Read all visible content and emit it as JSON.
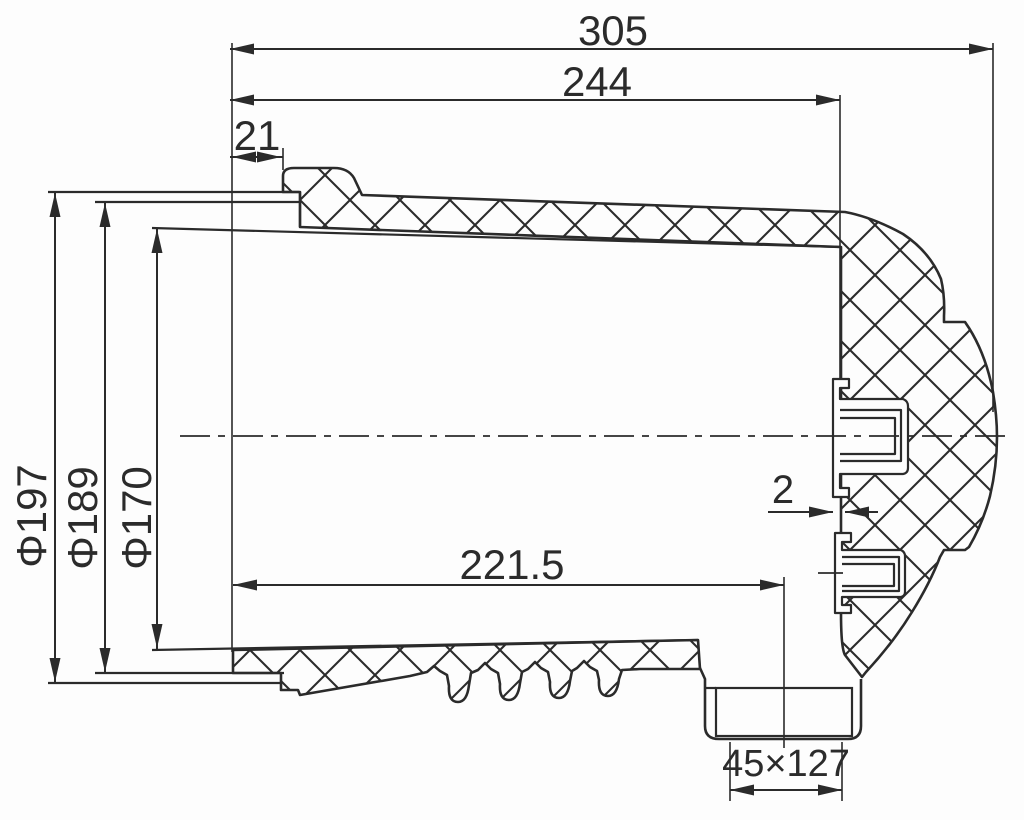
{
  "meta": {
    "kind": "engineering-cross-section-drawing",
    "background": "#fdfdfd",
    "line_color": "#2b2b2b",
    "hatch_spacing": 50
  },
  "dimensions": {
    "overall_length": {
      "label": "305"
    },
    "flange_to_insert": {
      "label": "244"
    },
    "collar_offset": {
      "label": "21"
    },
    "outer_diameter": {
      "label": "Φ197"
    },
    "flange_diameter": {
      "label": "Φ189"
    },
    "opening_diameter": {
      "label": "Φ170"
    },
    "depth_to_hole": {
      "label": "221.5"
    },
    "insert_gap": {
      "label": "2"
    },
    "duct_hole": {
      "label": "45×127"
    }
  },
  "svg_elements": [
    {
      "kind": "path",
      "name": "upper-wall-and-dome-section",
      "d": "M 300,227 L 300,192 L 283,192 L 283,176 Q 283,168 294,168 L 334,168 Q 348,168 354,178 L 362,195 L 845,212 Q 872,217 903,234 Q 930,252 941,279 Q 945,296 944,316 L 944,322 L 965,322 L 969,328 Q 986,355 993,392 Q 997,416 997,437 Q 997,466 990,496 Q 983,523 969,547 L 965,550 L 944,550 L 940,557 Q 930,583 912,612 Q 893,643 866,672 L 862,677 L 845,655 Q 841,648 841,613 L 841,247 Z",
      "fill": "hatch",
      "w": 2.6
    },
    {
      "kind": "path",
      "name": "lower-wall-section",
      "d": "M 233,650 L 698,640 L 700,669 L 640,669 L 622,670 L 619,679 Q 617,696 608,696 Q 598,696 599,680 L 597,671 L 590,667 L 584,661 L 577,668 L 572,671 L 570,681 Q 568,698 559,698 Q 549,698 550,682 L 548,672 L 541,668 L 535,662 L 528,669 L 522,672 L 520,683 Q 518,700 509,700 Q 499,700 500,684 L 498,673 L 491,669 L 485,663 L 478,670 L 471,673 L 469,685 Q 467,702 458,702 Q 448,702 449,686 L 447,675 L 440,671 L 434,666 L 427,672 L 410,676 L 300,695 L 298,690 L 281,690 L 281,673 L 233,673 Z",
      "fill": "hatch",
      "w": 2.6
    },
    {
      "kind": "path",
      "name": "bottom-duct-outline",
      "d": "M 700,668 L 705,679 L 705,726 Q 705,739 719,739 L 848,739 Q 861,739 861,726 L 861,679",
      "fill": "none",
      "w": 2.6
    },
    {
      "kind": "rect",
      "name": "duct-opening",
      "x": 716,
      "y": 688,
      "width": 136,
      "height": 48,
      "fill": "#fdfdfd",
      "w": 2.2
    },
    {
      "kind": "line",
      "name": "duct-top-stub",
      "x1": 705,
      "y1": 688,
      "x2": 716,
      "y2": 688,
      "w": 2.2
    },
    {
      "kind": "path",
      "name": "upper-metal-insert",
      "d": "M 833,379 L 849,379 L 849,388 L 840,388 L 840,399 L 903,399 Q 908,401 908,406 L 908,468 Q 908,473 903,474 L 840,474 L 840,488 L 849,488 L 849,497 L 833,497 Z",
      "fill": "#fdfdfd",
      "w": 2.2
    },
    {
      "kind": "path",
      "name": "upper-insert-bore-outer",
      "d": "M 840,410 H 901 V 461 H 840",
      "fill": "none",
      "w": 2.2
    },
    {
      "kind": "path",
      "name": "upper-insert-bore-inner",
      "d": "M 840,418 H 895 V 454 H 840",
      "fill": "none",
      "w": 2.2
    },
    {
      "kind": "path",
      "name": "lower-metal-insert",
      "d": "M 835,533 L 851,533 L 851,542 L 842,542 L 842,550 L 901,550 Q 905,552 905,556 L 905,592 Q 905,596 901,597 L 842,597 L 842,605 L 851,605 L 851,613 L 835,613 Z",
      "fill": "#fdfdfd",
      "w": 2.2
    },
    {
      "kind": "path",
      "name": "lower-insert-bore-outer",
      "d": "M 842,557 H 899 V 591 H 842",
      "fill": "none",
      "w": 2.2
    },
    {
      "kind": "path",
      "name": "lower-insert-bore-inner",
      "d": "M 842,564 H 894 V 586 H 842",
      "fill": "none",
      "w": 2.2
    },
    {
      "kind": "line",
      "name": "flange-ring-top-outer",
      "x1": 48,
      "y1": 192,
      "x2": 299,
      "y2": 192,
      "w": 2.2
    },
    {
      "kind": "line",
      "name": "flange-ring-top-inner",
      "x1": 95,
      "y1": 202,
      "x2": 299,
      "y2": 202,
      "w": 2.2
    },
    {
      "kind": "line",
      "name": "mouth-face-top",
      "x1": 300,
      "y1": 192,
      "x2": 300,
      "y2": 227,
      "w": 2.2
    },
    {
      "kind": "line",
      "name": "cavity-top-line",
      "x1": 152,
      "y1": 228,
      "x2": 841,
      "y2": 247,
      "w": 2.2
    },
    {
      "kind": "line",
      "name": "cavity-bottom-line",
      "x1": 152,
      "y1": 650,
      "x2": 698,
      "y2": 640,
      "w": 2.2
    },
    {
      "kind": "line",
      "name": "flange-ring-bottom-inner",
      "x1": 95,
      "y1": 673,
      "x2": 284,
      "y2": 673,
      "w": 2.2
    },
    {
      "kind": "line",
      "name": "flange-ring-bottom-outer",
      "x1": 48,
      "y1": 683,
      "x2": 281,
      "y2": 683,
      "w": 2.2
    },
    {
      "kind": "line",
      "name": "insert-bore-leader",
      "x1": 818,
      "y1": 573,
      "x2": 843,
      "y2": 573,
      "w": 1.8
    },
    {
      "kind": "line",
      "name": "centerline",
      "x1": 180,
      "y1": 436,
      "x2": 1012,
      "y2": 436,
      "w": 1.8,
      "dash": "30 8 7 8"
    },
    {
      "kind": "line",
      "name": "ext-line-mouth-face",
      "x1": 232,
      "y1": 43,
      "x2": 232,
      "y2": 652,
      "w": 1.6
    },
    {
      "kind": "line",
      "name": "ext-line-collar",
      "x1": 283,
      "y1": 148,
      "x2": 283,
      "y2": 170,
      "w": 1.6
    },
    {
      "kind": "line",
      "name": "ext-line-insert-face",
      "x1": 840,
      "y1": 95,
      "x2": 840,
      "y2": 379,
      "w": 1.6
    },
    {
      "kind": "line",
      "name": "ext-line-dome-end",
      "x1": 993,
      "y1": 43,
      "x2": 993,
      "y2": 412,
      "w": 1.6
    },
    {
      "kind": "line",
      "name": "ext-line-hole-center",
      "x1": 784,
      "y1": 577,
      "x2": 784,
      "y2": 748,
      "w": 1.6
    },
    {
      "kind": "line",
      "name": "ext-line-duct-left",
      "x1": 730,
      "y1": 742,
      "x2": 730,
      "y2": 801,
      "w": 1.6
    },
    {
      "kind": "line",
      "name": "ext-line-duct-right",
      "x1": 842,
      "y1": 742,
      "x2": 842,
      "y2": 801,
      "w": 1.6
    },
    {
      "kind": "line",
      "name": "dim-line-305",
      "x1": 230,
      "y1": 49,
      "x2": 993,
      "y2": 49,
      "w": 2
    },
    {
      "kind": "arrow",
      "name": "arrow-305-left",
      "x": 230,
      "y": 49,
      "dir": "left"
    },
    {
      "kind": "arrow",
      "name": "arrow-305-right",
      "x": 993,
      "y": 49,
      "dir": "right"
    },
    {
      "kind": "text",
      "name": "dim-label-305",
      "bind": "dimensions.overall_length.label",
      "x": 613,
      "y": 45,
      "size": 42,
      "anchor": "middle"
    },
    {
      "kind": "line",
      "name": "dim-line-244",
      "x1": 230,
      "y1": 100,
      "x2": 840,
      "y2": 100,
      "w": 2
    },
    {
      "kind": "arrow",
      "name": "arrow-244-left",
      "x": 230,
      "y": 100,
      "dir": "left"
    },
    {
      "kind": "arrow",
      "name": "arrow-244-right",
      "x": 840,
      "y": 100,
      "dir": "right"
    },
    {
      "kind": "text",
      "name": "dim-label-244",
      "bind": "dimensions.flange_to_insert.label",
      "x": 597,
      "y": 96,
      "size": 42,
      "anchor": "middle"
    },
    {
      "kind": "line",
      "name": "dim-line-21",
      "x1": 230,
      "y1": 157,
      "x2": 283,
      "y2": 157,
      "w": 2
    },
    {
      "kind": "arrow",
      "name": "arrow-21-left",
      "x": 232,
      "y": 157,
      "dir": "left"
    },
    {
      "kind": "arrow",
      "name": "arrow-21-right",
      "x": 281,
      "y": 157,
      "dir": "right"
    },
    {
      "kind": "text",
      "name": "dim-label-21",
      "bind": "dimensions.collar_offset.label",
      "x": 257,
      "y": 150,
      "size": 42,
      "anchor": "middle"
    },
    {
      "kind": "line",
      "name": "dim-line-d197",
      "x1": 55,
      "y1": 192,
      "x2": 55,
      "y2": 683,
      "w": 2
    },
    {
      "kind": "arrow",
      "name": "arrow-d197-top",
      "x": 55,
      "y": 193,
      "dir": "up"
    },
    {
      "kind": "arrow",
      "name": "arrow-d197-bottom",
      "x": 55,
      "y": 682,
      "dir": "down"
    },
    {
      "kind": "text",
      "name": "dim-label-d197",
      "bind": "dimensions.outer_diameter.label",
      "x": 0,
      "y": 0,
      "size": 42,
      "anchor": "middle",
      "transform": "translate(46,516) rotate(-90)"
    },
    {
      "kind": "line",
      "name": "dim-line-d189",
      "x1": 105,
      "y1": 202,
      "x2": 105,
      "y2": 673,
      "w": 2
    },
    {
      "kind": "arrow",
      "name": "arrow-d189-top",
      "x": 105,
      "y": 203,
      "dir": "up"
    },
    {
      "kind": "arrow",
      "name": "arrow-d189-bottom",
      "x": 105,
      "y": 672,
      "dir": "down"
    },
    {
      "kind": "text",
      "name": "dim-label-d189",
      "bind": "dimensions.flange_diameter.label",
      "x": 0,
      "y": 0,
      "size": 42,
      "anchor": "middle",
      "transform": "translate(97,518) rotate(-90)"
    },
    {
      "kind": "line",
      "name": "dim-line-d170",
      "x1": 157,
      "y1": 228,
      "x2": 157,
      "y2": 649,
      "w": 2
    },
    {
      "kind": "arrow",
      "name": "arrow-d170-top",
      "x": 157,
      "y": 229,
      "dir": "up"
    },
    {
      "kind": "arrow",
      "name": "arrow-d170-bottom",
      "x": 157,
      "y": 648,
      "dir": "down"
    },
    {
      "kind": "text",
      "name": "dim-label-d170",
      "bind": "dimensions.opening_diameter.label",
      "x": 0,
      "y": 0,
      "size": 42,
      "anchor": "middle",
      "transform": "translate(151,518) rotate(-90)"
    },
    {
      "kind": "line",
      "name": "dim-line-2215",
      "x1": 233,
      "y1": 585,
      "x2": 784,
      "y2": 585,
      "w": 2
    },
    {
      "kind": "arrow",
      "name": "arrow-2215-left",
      "x": 233,
      "y": 585,
      "dir": "left"
    },
    {
      "kind": "arrow",
      "name": "arrow-2215-right",
      "x": 784,
      "y": 585,
      "dir": "right"
    },
    {
      "kind": "text",
      "name": "dim-label-2215",
      "bind": "dimensions.depth_to_hole.label",
      "x": 512,
      "y": 579,
      "size": 42,
      "anchor": "middle"
    },
    {
      "kind": "line",
      "name": "dim-line-2-left",
      "x1": 768,
      "y1": 512,
      "x2": 833,
      "y2": 512,
      "w": 2
    },
    {
      "kind": "arrow",
      "name": "arrow-2-right-tip",
      "x": 833,
      "y": 512,
      "dir": "right"
    },
    {
      "kind": "line",
      "name": "dim-line-2-right",
      "x1": 845,
      "y1": 512,
      "x2": 878,
      "y2": 512,
      "w": 2
    },
    {
      "kind": "arrow",
      "name": "arrow-2-left-tip",
      "x": 845,
      "y": 512,
      "dir": "left"
    },
    {
      "kind": "text",
      "name": "dim-label-2",
      "bind": "dimensions.insert_gap.label",
      "x": 783,
      "y": 503,
      "size": 40,
      "anchor": "middle"
    },
    {
      "kind": "line",
      "name": "dim-line-45x127",
      "x1": 730,
      "y1": 790,
      "x2": 842,
      "y2": 790,
      "w": 2
    },
    {
      "kind": "arrow",
      "name": "arrow-45-left",
      "x": 730,
      "y": 790,
      "dir": "left"
    },
    {
      "kind": "arrow",
      "name": "arrow-45-right",
      "x": 842,
      "y": 790,
      "dir": "right"
    },
    {
      "kind": "text",
      "name": "dim-label-45x127",
      "bind": "dimensions.duct_hole.label",
      "x": 786,
      "y": 776,
      "size": 38,
      "anchor": "middle"
    }
  ]
}
